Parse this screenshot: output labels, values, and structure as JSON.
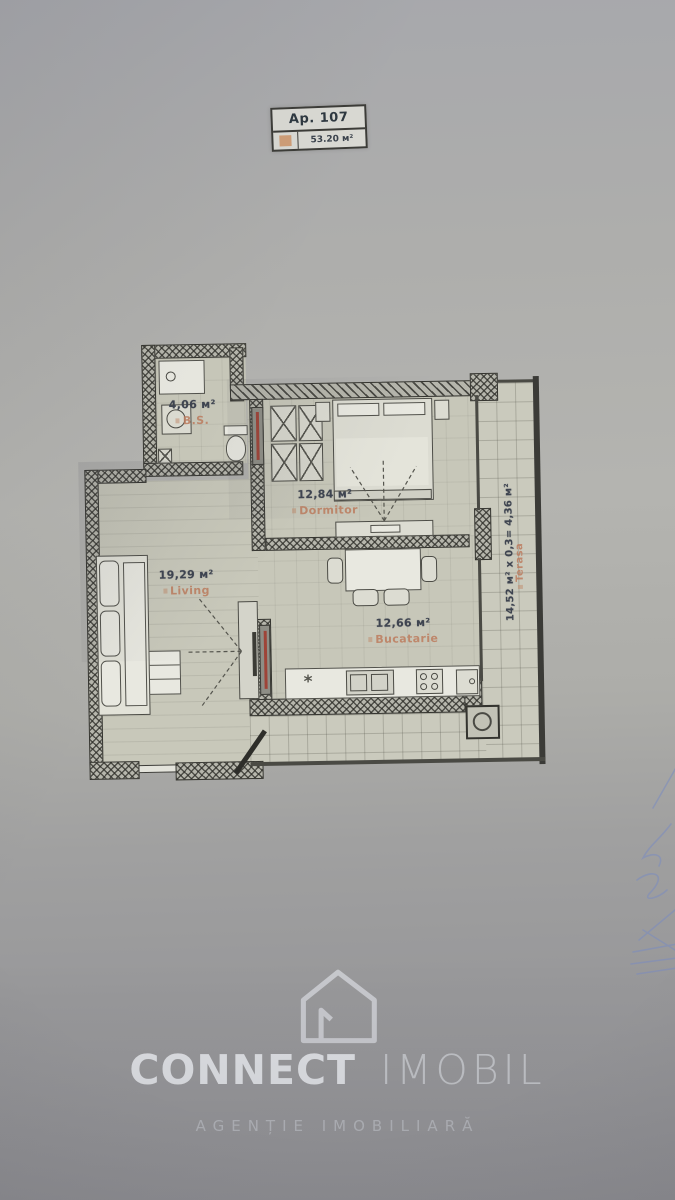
{
  "title_box": {
    "apartment": "Ap. 107",
    "total_area": "53.20 м²"
  },
  "rooms": {
    "bathroom": {
      "area": "4,06 м²",
      "name": "B.S."
    },
    "bedroom": {
      "area": "12,84 м²",
      "name": "Dormitor"
    },
    "living": {
      "area": "19,29 м²",
      "name": "Living"
    },
    "kitchen": {
      "area": "12,66 м²",
      "name": "Bucatarie"
    },
    "terrace": {
      "calculation": "14,52 м² x 0,3= 4,36 м²",
      "name": "Terasa"
    }
  },
  "watermark": {
    "brand_primary": "CONNECT",
    "brand_secondary": "IMOBIL",
    "tagline": "AGENȚIE IMOBILIARĂ"
  },
  "colors": {
    "room_name_accent": "#bd7c5e",
    "area_text": "#3e4450",
    "legend_square": "#cd9366",
    "signature_ink": "#7b8cc0"
  }
}
